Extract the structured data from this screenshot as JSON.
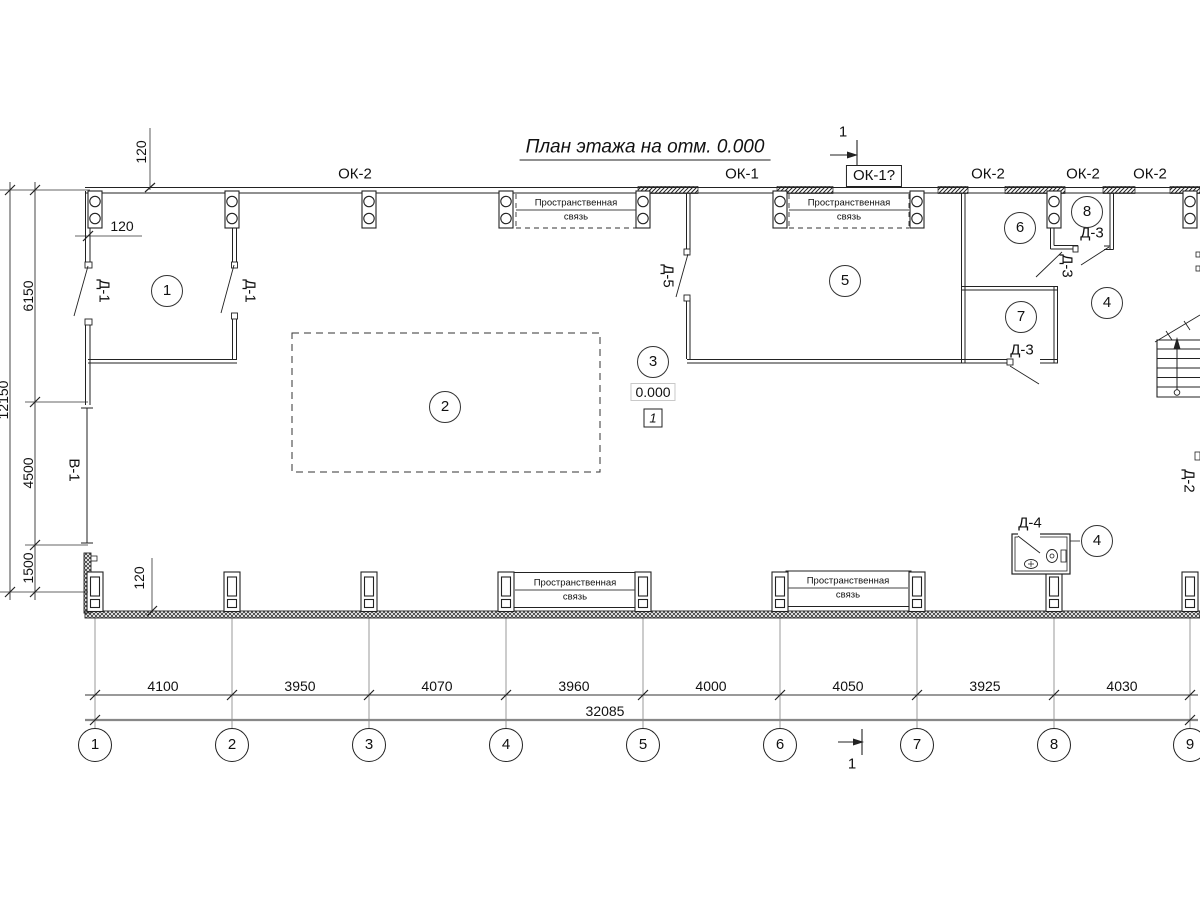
{
  "title": "План этажа на отм. 0.000",
  "section_cut": {
    "top_label": "1",
    "bottom_label": "1"
  },
  "windows": {
    "ok2_a": "ОК-2",
    "ok1": "ОК-1",
    "ok1_boxed": "ОК-1?",
    "ok2_b": "ОК-2",
    "ok2_c": "ОК-2",
    "ok2_d": "ОК-2"
  },
  "doors": {
    "d1_left": "Д-1",
    "d1_right": "Д-1",
    "d5": "Д-5",
    "d3_top": "Д-3",
    "d3_mid": "Д-3",
    "d3_low": "Д-3",
    "d4": "Д-4",
    "d2": "Д-2"
  },
  "opening_left": "В-1",
  "rooms": {
    "r1": "1",
    "r2": "2",
    "r3": "3",
    "r4a": "4",
    "r4b": "4",
    "r5": "5",
    "r6": "6",
    "r7": "7",
    "r8": "8"
  },
  "elevation": {
    "value": "0.000",
    "flag": "1"
  },
  "spatial_tie": {
    "line1": "Пространственная",
    "line2": "связь"
  },
  "dims": {
    "bottom_segments": [
      "4100",
      "3950",
      "4070",
      "3960",
      "4000",
      "4050",
      "3925",
      "4030"
    ],
    "bottom_total": "32085",
    "left_segments": [
      "6150",
      "4500",
      "1500"
    ],
    "left_total": "12150",
    "offset_top": "120",
    "offset_left": "120",
    "offset_bottom": "120"
  },
  "grid_axes": [
    "1",
    "2",
    "3",
    "4",
    "5",
    "6",
    "7",
    "8",
    "9"
  ]
}
